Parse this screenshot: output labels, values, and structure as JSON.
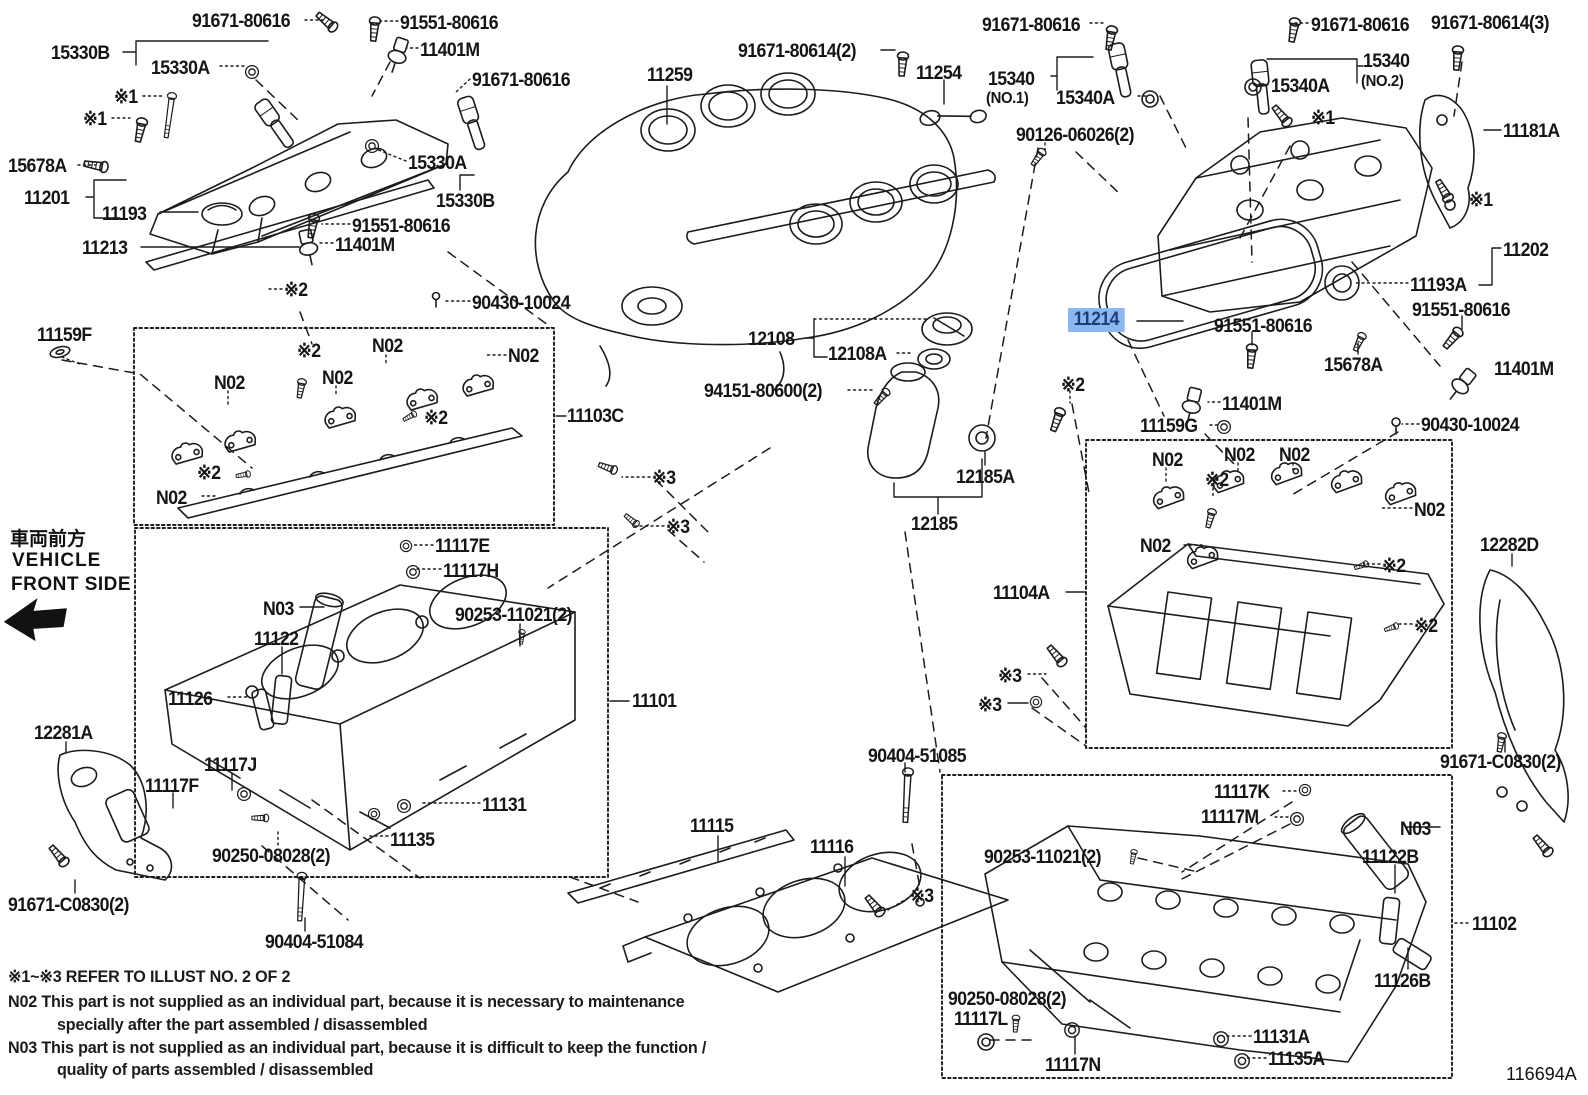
{
  "diagram": {
    "id": "116694A",
    "highlight": {
      "part": "11214",
      "background": "#8FB7EF",
      "text_color": "#1c3d7d"
    },
    "front_side": {
      "jp": "車両前方",
      "en_line1": "VEHICLE",
      "en_line2": "FRONT SIDE"
    },
    "notes": {
      "ref": "※1~※3  REFER TO ILLUST NO. 2 OF 2",
      "n02_line1": "N02  This part is not supplied as an individual part, because it is necessary to maintenance",
      "n02_line2": "specially after the part assembled / disassembled",
      "n03_line1": "N03  This part is not supplied as an individual part, because it is difficult to keep the function /",
      "n03_line2": "quality of parts  assembled / disassembled"
    },
    "labels": [
      {
        "t": "91671-80616",
        "x": 192,
        "y": 12
      },
      {
        "t": "91551-80616",
        "x": 400,
        "y": 14
      },
      {
        "t": "15330B",
        "x": 51,
        "y": 44
      },
      {
        "t": "15330A",
        "x": 151,
        "y": 59
      },
      {
        "t": "11401M",
        "x": 420,
        "y": 41
      },
      {
        "t": "91671-80616",
        "x": 472,
        "y": 71
      },
      {
        "t": "※1",
        "x": 114,
        "y": 88
      },
      {
        "t": "※1",
        "x": 83,
        "y": 110
      },
      {
        "t": "15678A",
        "x": 8,
        "y": 157
      },
      {
        "t": "11201",
        "x": 24,
        "y": 189
      },
      {
        "t": "11193",
        "x": 102,
        "y": 205
      },
      {
        "t": "11213",
        "x": 82,
        "y": 239
      },
      {
        "t": "15330A",
        "x": 408,
        "y": 154
      },
      {
        "t": "15330B",
        "x": 436,
        "y": 192
      },
      {
        "t": "91551-80616",
        "x": 352,
        "y": 217
      },
      {
        "t": "11401M",
        "x": 335,
        "y": 236
      },
      {
        "t": "11259",
        "x": 647,
        "y": 66
      },
      {
        "t": "91671-80614(2)",
        "x": 738,
        "y": 42
      },
      {
        "t": "11254",
        "x": 916,
        "y": 64
      },
      {
        "t": "91671-80616",
        "x": 982,
        "y": 16
      },
      {
        "t": "15340",
        "x": 988,
        "y": 70
      },
      {
        "t": "(NO.1)",
        "x": 986,
        "y": 91,
        "sm": true
      },
      {
        "t": "15340A",
        "x": 1056,
        "y": 89
      },
      {
        "t": "90126-06026(2)",
        "x": 1016,
        "y": 126
      },
      {
        "t": "91671-80616",
        "x": 1311,
        "y": 16
      },
      {
        "t": "91671-80614(3)",
        "x": 1431,
        "y": 14
      },
      {
        "t": "15340A",
        "x": 1271,
        "y": 77
      },
      {
        "t": "15340",
        "x": 1363,
        "y": 52
      },
      {
        "t": "(NO.2)",
        "x": 1361,
        "y": 74,
        "sm": true
      },
      {
        "t": "11181A",
        "x": 1503,
        "y": 122
      },
      {
        "t": "※1",
        "x": 1311,
        "y": 109
      },
      {
        "t": "※1",
        "x": 1469,
        "y": 191
      },
      {
        "t": "11202",
        "x": 1503,
        "y": 241
      },
      {
        "t": "11193A",
        "x": 1410,
        "y": 276
      },
      {
        "t": "91551-80616",
        "x": 1412,
        "y": 301
      },
      {
        "t": "11214",
        "x": 1068,
        "y": 308,
        "hl": true
      },
      {
        "t": "91551-80616",
        "x": 1214,
        "y": 317
      },
      {
        "t": "15678A",
        "x": 1324,
        "y": 356
      },
      {
        "t": "11401M",
        "x": 1494,
        "y": 360
      },
      {
        "t": "※2",
        "x": 1061,
        "y": 376
      },
      {
        "t": "11401M",
        "x": 1222,
        "y": 395
      },
      {
        "t": "11159G",
        "x": 1140,
        "y": 417
      },
      {
        "t": "90430-10024",
        "x": 1421,
        "y": 416
      },
      {
        "t": "11159F",
        "x": 37,
        "y": 326
      },
      {
        "t": "※2",
        "x": 284,
        "y": 281
      },
      {
        "t": "90430-10024",
        "x": 472,
        "y": 294
      },
      {
        "t": "N02",
        "x": 214,
        "y": 374
      },
      {
        "t": "N02",
        "x": 322,
        "y": 369
      },
      {
        "t": "N02",
        "x": 372,
        "y": 337
      },
      {
        "t": "N02",
        "x": 508,
        "y": 347
      },
      {
        "t": "N02",
        "x": 156,
        "y": 489
      },
      {
        "t": "※2",
        "x": 297,
        "y": 342
      },
      {
        "t": "※2",
        "x": 424,
        "y": 409
      },
      {
        "t": "※2",
        "x": 197,
        "y": 464
      },
      {
        "t": "11103C",
        "x": 567,
        "y": 407
      },
      {
        "t": "N02",
        "x": 1152,
        "y": 451
      },
      {
        "t": "N02",
        "x": 1224,
        "y": 446
      },
      {
        "t": "N02",
        "x": 1279,
        "y": 446
      },
      {
        "t": "N02",
        "x": 1414,
        "y": 501
      },
      {
        "t": "N02",
        "x": 1140,
        "y": 537
      },
      {
        "t": "※2",
        "x": 1205,
        "y": 471
      },
      {
        "t": "※2",
        "x": 1382,
        "y": 557
      },
      {
        "t": "※2",
        "x": 1414,
        "y": 617
      },
      {
        "t": "11104A",
        "x": 993,
        "y": 584
      },
      {
        "t": "12282D",
        "x": 1480,
        "y": 536
      },
      {
        "t": "※3",
        "x": 998,
        "y": 667
      },
      {
        "t": "※3",
        "x": 978,
        "y": 696
      },
      {
        "t": "12108",
        "x": 748,
        "y": 330
      },
      {
        "t": "12108A",
        "x": 828,
        "y": 345
      },
      {
        "t": "94151-80600(2)",
        "x": 704,
        "y": 382
      },
      {
        "t": "12185A",
        "x": 956,
        "y": 468
      },
      {
        "t": "12185",
        "x": 911,
        "y": 515
      },
      {
        "t": "※3",
        "x": 652,
        "y": 469
      },
      {
        "t": "※3",
        "x": 666,
        "y": 518
      },
      {
        "t": "12281A",
        "x": 34,
        "y": 724
      },
      {
        "t": "91671-C0830(2)",
        "x": 8,
        "y": 896
      },
      {
        "t": "N03",
        "x": 263,
        "y": 600
      },
      {
        "t": "11122",
        "x": 254,
        "y": 630
      },
      {
        "t": "11126",
        "x": 168,
        "y": 690
      },
      {
        "t": "11117E",
        "x": 435,
        "y": 537
      },
      {
        "t": "11117H",
        "x": 443,
        "y": 562
      },
      {
        "t": "90253-11021(2)",
        "x": 455,
        "y": 606
      },
      {
        "t": "11101",
        "x": 632,
        "y": 692
      },
      {
        "t": "11117J",
        "x": 204,
        "y": 756
      },
      {
        "t": "11117F",
        "x": 145,
        "y": 777
      },
      {
        "t": "11131",
        "x": 482,
        "y": 796
      },
      {
        "t": "11135",
        "x": 390,
        "y": 831
      },
      {
        "t": "90250-08028(2)",
        "x": 212,
        "y": 847
      },
      {
        "t": "90404-51084",
        "x": 265,
        "y": 933
      },
      {
        "t": "11115",
        "x": 690,
        "y": 817
      },
      {
        "t": "11116",
        "x": 810,
        "y": 838
      },
      {
        "t": "※3",
        "x": 910,
        "y": 887
      },
      {
        "t": "90404-51085",
        "x": 868,
        "y": 747
      },
      {
        "t": "90253-11021(2)",
        "x": 984,
        "y": 848
      },
      {
        "t": "11117K",
        "x": 1214,
        "y": 783
      },
      {
        "t": "11117M",
        "x": 1201,
        "y": 808
      },
      {
        "t": "91671-C0830(2)",
        "x": 1440,
        "y": 753
      },
      {
        "t": "N03",
        "x": 1400,
        "y": 820
      },
      {
        "t": "11122B",
        "x": 1362,
        "y": 848
      },
      {
        "t": "11102",
        "x": 1472,
        "y": 915
      },
      {
        "t": "11126B",
        "x": 1374,
        "y": 972
      },
      {
        "t": "90250-08028(2)",
        "x": 948,
        "y": 990
      },
      {
        "t": "11117L",
        "x": 954,
        "y": 1010
      },
      {
        "t": "11117N",
        "x": 1045,
        "y": 1056
      },
      {
        "t": "11131A",
        "x": 1253,
        "y": 1028
      },
      {
        "t": "11135A",
        "x": 1268,
        "y": 1050
      }
    ]
  }
}
